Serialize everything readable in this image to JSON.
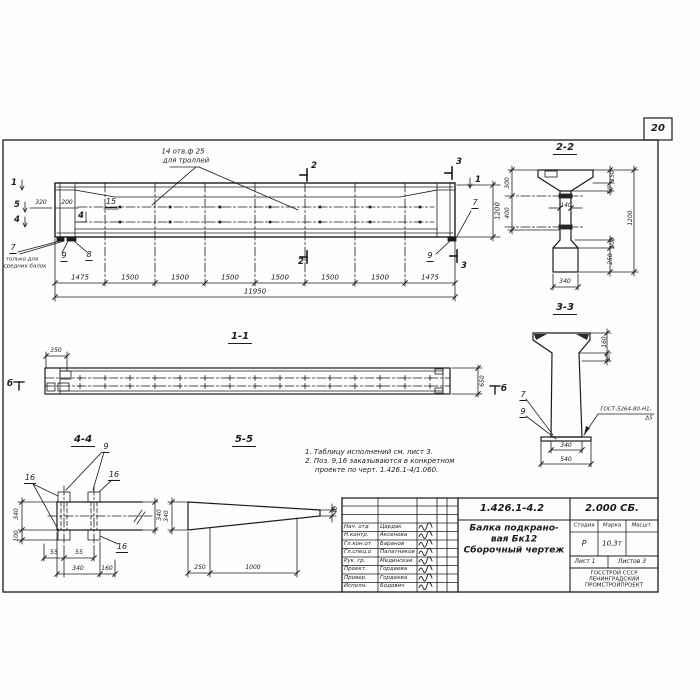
{
  "page": {
    "sheet_number": "20"
  },
  "main_view": {
    "hole_note_line1": "14 отв.ф 25",
    "hole_note_line2": "для троллей",
    "marker_1_left": "1",
    "marker_5_left": "5",
    "marker_4_left": "4",
    "marker_1_right": "1",
    "marker_2_top": "2",
    "marker_2_bottom": "2",
    "marker_3_top": "3",
    "marker_3_bottom": "3",
    "dim_320": "320",
    "dim_200": "200",
    "pos_15": "15",
    "pos_4_inline": "4",
    "pos_7_left": "7",
    "note_7_line1": "только для",
    "note_7_line2": "средних балок",
    "pos_9_left": "9",
    "pos_8_left": "8",
    "pos_7_right": "7",
    "pos_9_right": "9",
    "dim_1200_right": "1200",
    "dims_bottom": [
      "1475",
      "1500",
      "1500",
      "1500",
      "1500",
      "1500",
      "1500",
      "1475"
    ],
    "dim_total": "11950"
  },
  "section_22": {
    "title": "2-2",
    "dim_300": "300",
    "dim_400": "400",
    "dim_140": "140",
    "dim_150": "150",
    "dim_50": "50",
    "dim_1200": "1200",
    "dim_100": "100",
    "dim_250": "250",
    "dim_340": "340"
  },
  "section_33": {
    "title": "3-3",
    "dim_160": "160",
    "dim_30": "30",
    "pos_7": "7",
    "pos_9": "9",
    "weld_line1": "ГОСТ-5264-80-Н1-",
    "weld_line2": "Δ5",
    "dim_340": "340",
    "dim_540": "540"
  },
  "section_11": {
    "title": "1-1",
    "dim_350": "350",
    "dim_650": "650",
    "marker_b_left": "б",
    "marker_b_right": "б"
  },
  "detail_44": {
    "title": "4-4",
    "pos_9": "9",
    "pos_16_left": "16",
    "pos_16_right": "16",
    "pos_16_bottom": "16",
    "dim_340_left": "340",
    "dim_100_left": "100",
    "dim_340_right": "340",
    "dim_55_a": "55",
    "dim_55_b": "55",
    "dim_340_bottom": "340",
    "dim_160_bottom": "160"
  },
  "detail_55": {
    "title": "5-5",
    "dim_340": "340",
    "dim_250": "250",
    "dim_1000": "1000",
    "dim_40": "40"
  },
  "notes": {
    "line1": "1. Таблицу исполнений см. лист 3.",
    "line2": "2. Поз. 9,16 заказываются в конкретном",
    "line3": "проекте по черт. 1.426.1-4/1.060."
  },
  "title_block": {
    "doc_number": "1.426.1-4.2",
    "doc_code": "2.000 СБ.",
    "title_line1": "Балка подкрано-",
    "title_line2": "вая Бк12",
    "title_line3": "Сборочный чертеж",
    "stage_label": "Стадия",
    "mark_label": "Марка",
    "scale_label": "Масшт.",
    "stage_value": "Р",
    "mark_value": "10,3т",
    "sheet_label": "Лист 1",
    "sheets_label": "Листов 3",
    "org_line1": "ГОССТРОЙ СССР",
    "org_line2": "ЛЕНИНГРАДСКИЙ",
    "org_line3": "ПРОМСТРОЙПРОЕКТ",
    "signatures": [
      {
        "role": "Нач. отд",
        "name": "Цардак"
      },
      {
        "role": "Н.контр.",
        "name": "Аксенова"
      },
      {
        "role": "Гл.кон.от",
        "name": "Баранов"
      },
      {
        "role": "Гл.спец.о",
        "name": "Палатников"
      },
      {
        "role": "Рук. гр.",
        "name": "Мединская"
      },
      {
        "role": "Проект.",
        "name": "Гордеева"
      },
      {
        "role": "Провер.",
        "name": "Гордеева"
      },
      {
        "role": "Исполн.",
        "name": "Бодович"
      }
    ]
  }
}
